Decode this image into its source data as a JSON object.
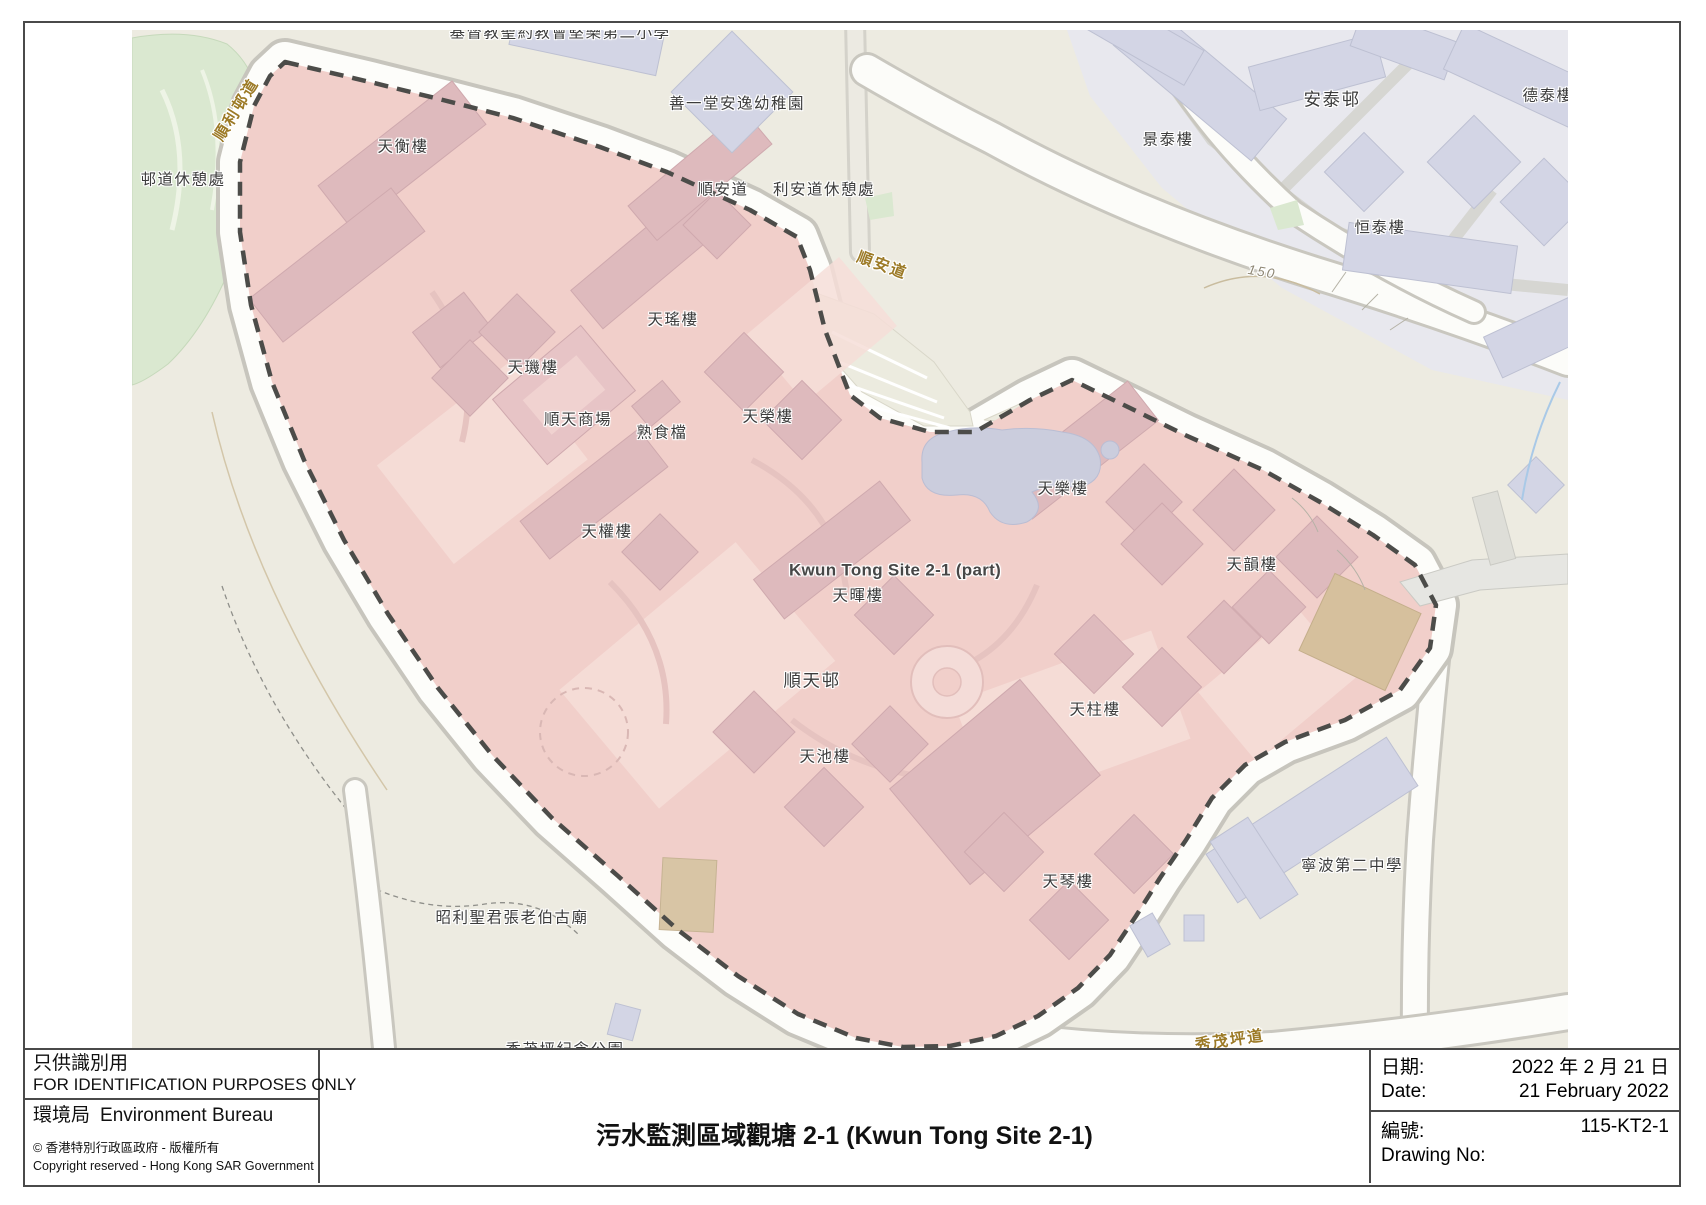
{
  "title_block": {
    "left": {
      "use_zh": "只供識別用",
      "use_en": "FOR IDENTIFICATION PURPOSES ONLY",
      "bureau_zh": "環境局",
      "bureau_en": "Environment Bureau",
      "copyright_zh": "©  香港特別行政區政府  -  版權所有",
      "copyright_en": "Copyright reserved - Hong Kong SAR Government"
    },
    "title": "污水監測區域觀塘  2-1 (Kwun Tong Site 2-1)",
    "right": {
      "date_label_zh": "日期:",
      "date_value_zh": "2022 年 2 月 21 日",
      "date_label_en": "Date:",
      "date_value_en": "21 February 2022",
      "no_label_zh": "編號:",
      "no_value": "115-KT2-1",
      "no_label_en": "Drawing No:"
    }
  },
  "colors": {
    "site_fill": "#f1cfca",
    "site_building": "#debabd",
    "boundary_dash": "#4c4c49",
    "road_label_brown": "#9c7a26",
    "map_background": "#edebe1"
  },
  "map": {
    "labels": [
      {
        "name": "school-top-clipped",
        "text": "基督教聖約教會堅樂第二小學",
        "x": 428,
        "y": 3,
        "kind": "place"
      },
      {
        "name": "kindergarten",
        "text": "善一堂安逸幼稚園",
        "x": 605,
        "y": 74,
        "kind": "place"
      },
      {
        "name": "shun-on-road-name",
        "text": "順安道",
        "x": 591,
        "y": 160,
        "kind": "place"
      },
      {
        "name": "lee-on-road-rest-garden",
        "text": "利安道休憩處",
        "x": 692,
        "y": 160,
        "kind": "place"
      },
      {
        "name": "shun-lee-estate-road",
        "text": "順利邨道",
        "x": 105,
        "y": 80,
        "kind": "road",
        "rot": -58
      },
      {
        "name": "estate-road-rest-garden",
        "text": "邨道休憩處",
        "x": 51,
        "y": 150,
        "kind": "place"
      },
      {
        "name": "shun-on-road",
        "text": "順安道",
        "x": 750,
        "y": 236,
        "kind": "road",
        "rot": 20
      },
      {
        "name": "contour-150",
        "text": "150",
        "x": 1130,
        "y": 242,
        "kind": "contour",
        "rot": 10
      },
      {
        "name": "king-tai-house",
        "text": "景泰樓",
        "x": 1036,
        "y": 110,
        "kind": "place"
      },
      {
        "name": "on-tai-estate",
        "text": "安泰邨",
        "x": 1200,
        "y": 70,
        "kind": "estate"
      },
      {
        "name": "tak-tai-house",
        "text": "德泰樓",
        "x": 1416,
        "y": 66,
        "kind": "place"
      },
      {
        "name": "hang-tai-house",
        "text": "恒泰樓",
        "x": 1248,
        "y": 198,
        "kind": "place"
      },
      {
        "name": "tin-hang-house",
        "text": "天衡樓",
        "x": 271,
        "y": 117,
        "kind": "place"
      },
      {
        "name": "tin-yiu-house",
        "text": "天瑤樓",
        "x": 541,
        "y": 290,
        "kind": "place"
      },
      {
        "name": "tin-kei-house",
        "text": "天璣樓",
        "x": 401,
        "y": 338,
        "kind": "place"
      },
      {
        "name": "shun-tin-shopping-centre",
        "text": "順天商場",
        "x": 446,
        "y": 390,
        "kind": "place"
      },
      {
        "name": "cooked-food-stalls",
        "text": "熟食檔",
        "x": 530,
        "y": 403,
        "kind": "place"
      },
      {
        "name": "tin-wing-house",
        "text": "天榮樓",
        "x": 636,
        "y": 387,
        "kind": "place"
      },
      {
        "name": "tin-kuen-house",
        "text": "天權樓",
        "x": 475,
        "y": 502,
        "kind": "place"
      },
      {
        "name": "site-name",
        "text": "Kwun Tong Site 2-1 (part)",
        "x": 763,
        "y": 540,
        "kind": "site"
      },
      {
        "name": "tin-fai-house",
        "text": "天暉樓",
        "x": 726,
        "y": 566,
        "kind": "place"
      },
      {
        "name": "tin-lok-house",
        "text": "天樂樓",
        "x": 931,
        "y": 459,
        "kind": "place"
      },
      {
        "name": "tin-wan-house",
        "text": "天韻樓",
        "x": 1120,
        "y": 535,
        "kind": "place"
      },
      {
        "name": "shun-tin-estate",
        "text": "順天邨",
        "x": 680,
        "y": 651,
        "kind": "estate"
      },
      {
        "name": "tin-chi-house",
        "text": "天池樓",
        "x": 693,
        "y": 727,
        "kind": "place"
      },
      {
        "name": "tin-chu-house",
        "text": "天柱樓",
        "x": 963,
        "y": 680,
        "kind": "place"
      },
      {
        "name": "tin-kam-house",
        "text": "天琴樓",
        "x": 936,
        "y": 852,
        "kind": "place"
      },
      {
        "name": "ning-po-no2-college",
        "text": "寧波第二中學",
        "x": 1220,
        "y": 836,
        "kind": "place"
      },
      {
        "name": "temple-chiu-lee-sing-kwan",
        "text": "昭利聖君張老伯古廟",
        "x": 380,
        "y": 888,
        "kind": "place"
      },
      {
        "name": "sau-mau-ping-road",
        "text": "秀茂坪道",
        "x": 1098,
        "y": 1011,
        "kind": "road",
        "rot": -8
      },
      {
        "name": "park-bottom-clipped",
        "text": "秀茂坪紀念公園",
        "x": 433,
        "y": 1020,
        "kind": "place"
      }
    ]
  }
}
